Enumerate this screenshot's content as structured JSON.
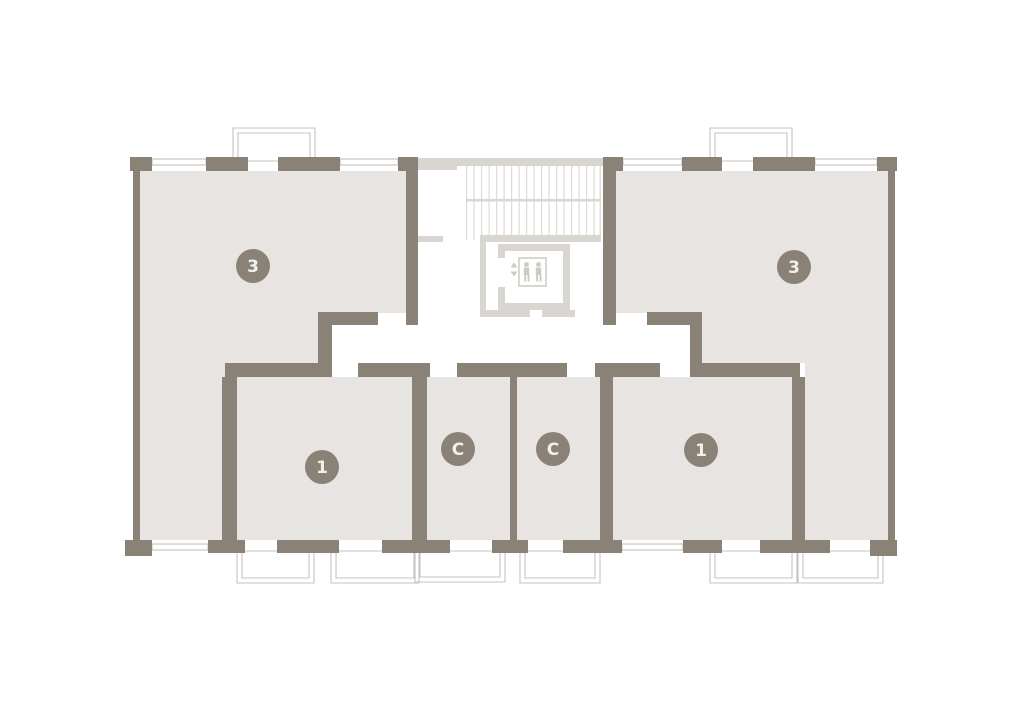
{
  "page": {
    "background": "#ffffff",
    "description": "Residential building floor plan with six units around a central stair and elevator core"
  },
  "plan": {
    "colors": {
      "wall": "#8a8277",
      "floor": "#e7e4e1",
      "core": "#d9d5d1",
      "tread": "#dedad6",
      "window": "#c9c6c2",
      "balcony": "#c6c3bf",
      "icon": "#cdc9c5",
      "badge_fill": "#8a8277",
      "badge_text": "#f2f0ed"
    },
    "badge": {
      "radius": 17
    },
    "units": [
      {
        "id": "apartment-3-left",
        "type": "apartment",
        "label": "3",
        "badge_x": 253,
        "badge_y": 266
      },
      {
        "id": "apartment-3-right",
        "type": "apartment",
        "label": "3",
        "badge_x": 794,
        "badge_y": 267
      },
      {
        "id": "apartment-1-left",
        "type": "apartment",
        "label": "1",
        "badge_x": 322,
        "badge_y": 467
      },
      {
        "id": "studio-left",
        "type": "studio",
        "label": "C",
        "badge_x": 458,
        "badge_y": 449
      },
      {
        "id": "studio-right",
        "type": "studio",
        "label": "C",
        "badge_x": 553,
        "badge_y": 449
      },
      {
        "id": "apartment-1-right",
        "type": "apartment",
        "label": "1",
        "badge_x": 701,
        "badge_y": 450
      }
    ],
    "core": {
      "has_stairs": true,
      "has_elevator": true,
      "elevator_icon": "two-persons-icon",
      "elevator_arrows": "up-down-arrows-icon"
    },
    "balcony_count": 8,
    "window_count": 6
  }
}
